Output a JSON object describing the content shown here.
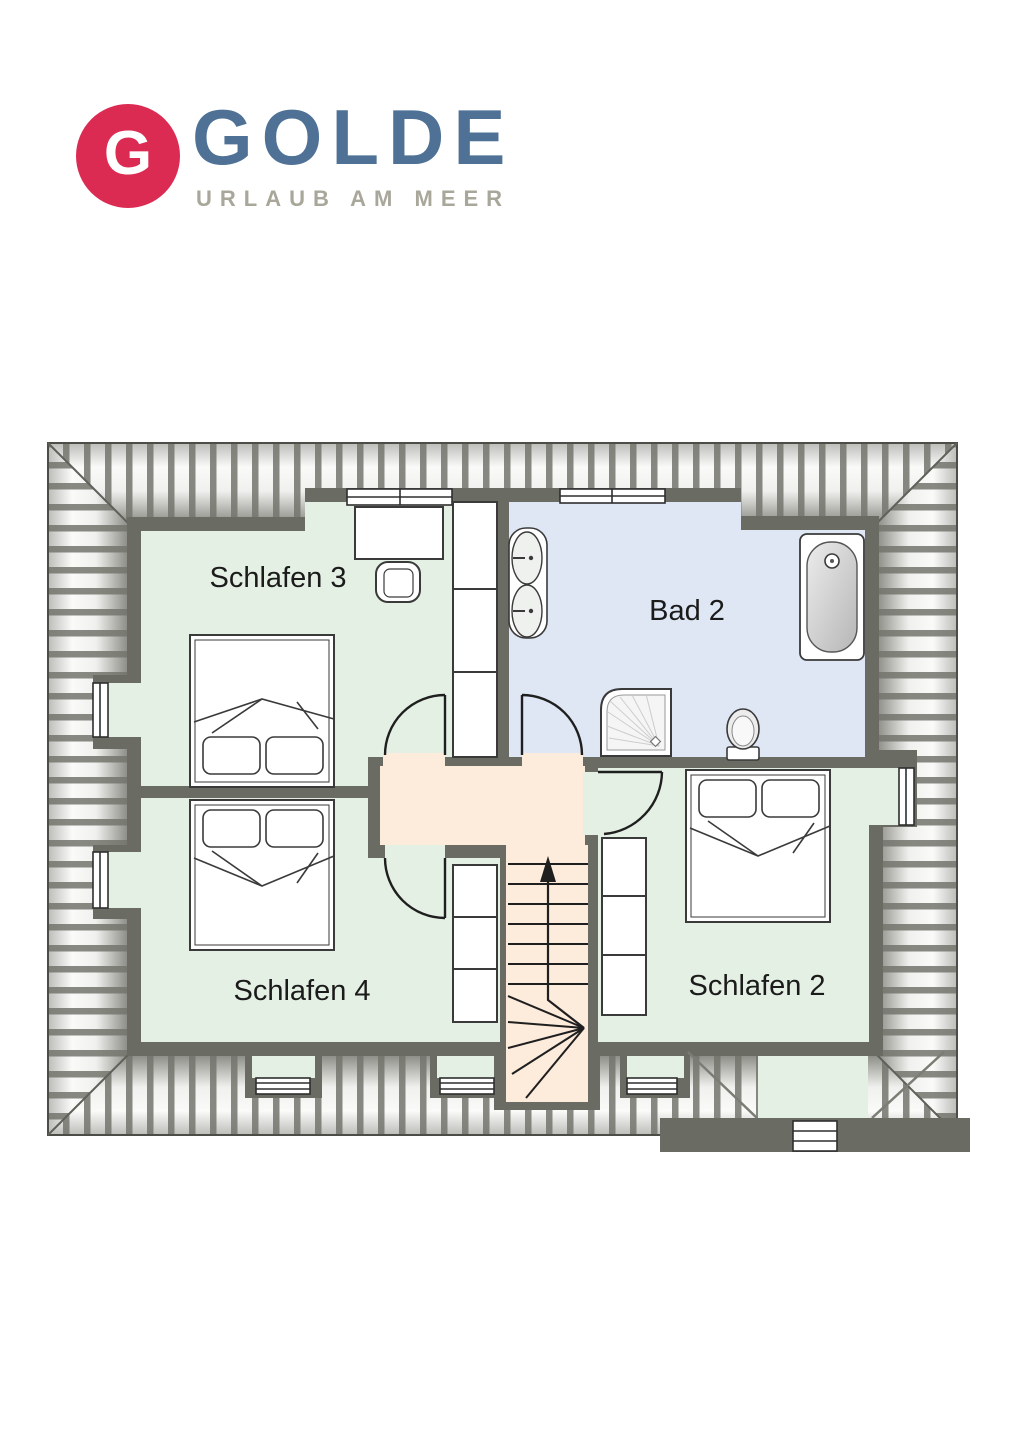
{
  "logo": {
    "monogram": "G",
    "title": "GOLDE",
    "subtitle": "URLAUB AM MEER"
  },
  "rooms": [
    {
      "label": "Schlafen 3"
    },
    {
      "label": "Bad 2"
    },
    {
      "label": "Schlafen 4"
    },
    {
      "label": "Schlafen 2"
    }
  ],
  "stairs": {
    "arrow_icon": "up-arrow"
  },
  "fixtures": [
    "double-bed-schlafen-3",
    "desk",
    "desk-chair",
    "wardrobe-schlafen-3",
    "double-washbasin",
    "shower",
    "toilet",
    "bathtub",
    "double-bed-schlafen-4",
    "wardrobe-schlafen-4",
    "double-bed-schlafen-2",
    "wardrobe-schlafen-2",
    "staircase",
    "window"
  ],
  "colors": {
    "brand_red": "#dc2b52",
    "brand_blue": "#4e7195",
    "subtitle_gray": "#a9a79a",
    "wall_gray": "#6a6b62",
    "bedroom_green": "#e4f0e3",
    "bath_blue": "#dfe7f4",
    "hall_peach": "#fdebdc",
    "roof_stripe": "#73746c"
  }
}
